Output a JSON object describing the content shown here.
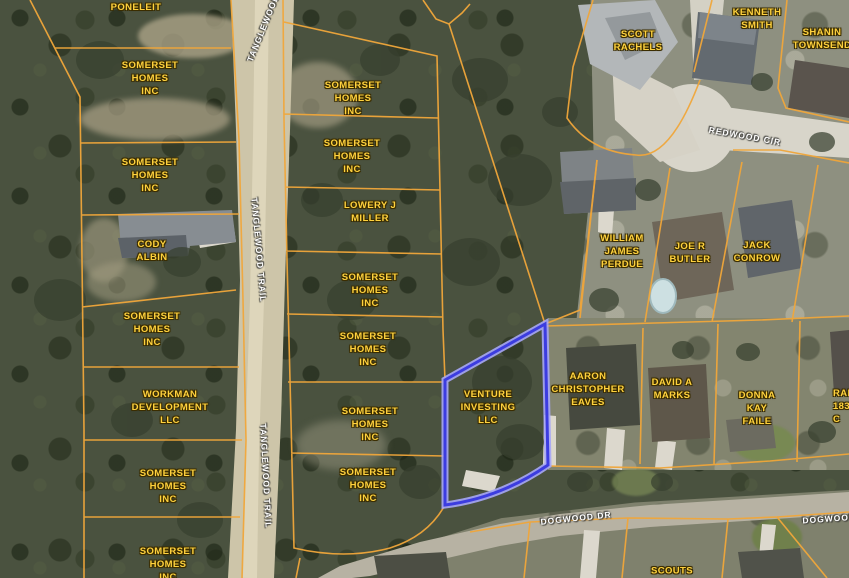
{
  "map_type": "parcel-aerial-map",
  "colors": {
    "parcel_line": "#f0a63a",
    "highlight_stroke": "#3c3ce0",
    "highlight_halo": "#a6a6f7",
    "owner_label": "#ffd23e",
    "owner_label_outline": "#3b2d00",
    "road_label": "#ffffff"
  },
  "selected_parcel": {
    "owner": "VENTURE INVESTING LLC"
  },
  "parcel_labels": [
    {
      "id": "poneleit",
      "text": "PONELEIT"
    },
    {
      "id": "somerset-1",
      "text": "SOMERSET\nHOMES\nINC"
    },
    {
      "id": "somerset-2",
      "text": "SOMERSET\nHOMES\nINC"
    },
    {
      "id": "cody-albin",
      "text": "CODY\nALBIN"
    },
    {
      "id": "somerset-3",
      "text": "SOMERSET\nHOMES\nINC"
    },
    {
      "id": "workman",
      "text": "WORKMAN\nDEVELOPMENT\nLLC"
    },
    {
      "id": "somerset-4",
      "text": "SOMERSET\nHOMES\nINC"
    },
    {
      "id": "somerset-5",
      "text": "SOMERSET\nHOMES\nINC"
    },
    {
      "id": "somerset-6",
      "text": "SOMERSET\nHOMES\nINC"
    },
    {
      "id": "somerset-7",
      "text": "SOMERSET\nHOMES\nINC"
    },
    {
      "id": "lowery-miller",
      "text": "LOWERY J\nMILLER"
    },
    {
      "id": "somerset-8",
      "text": "SOMERSET\nHOMES\nINC"
    },
    {
      "id": "somerset-9",
      "text": "SOMERSET\nHOMES\nINC"
    },
    {
      "id": "somerset-10",
      "text": "SOMERSET\nHOMES\nINC"
    },
    {
      "id": "somerset-11",
      "text": "SOMERSET\nHOMES\nINC"
    },
    {
      "id": "venture-investing",
      "text": "VENTURE\nINVESTING\nLLC"
    },
    {
      "id": "scott-rachels",
      "text": "SCOTT\nRACHELS"
    },
    {
      "id": "kenneth-smith",
      "text": "KENNETH\nSMITH"
    },
    {
      "id": "shanin-townsend",
      "text": "SHANIN\nTOWNSEND"
    },
    {
      "id": "william-perdue",
      "text": "WILLIAM\nJAMES\nPERDUE"
    },
    {
      "id": "joe-butler",
      "text": "JOE R\nBUTLER"
    },
    {
      "id": "jack-conrow",
      "text": "JACK\nCONROW"
    },
    {
      "id": "aaron-eaves",
      "text": "AARON\nCHRISTOPHER\nEAVES"
    },
    {
      "id": "david-marks",
      "text": "DAVID A\nMARKS"
    },
    {
      "id": "donna-faile",
      "text": "DONNA\nKAY\nFAILE"
    },
    {
      "id": "ranch-1836",
      "text": "RANC\n1836 C"
    },
    {
      "id": "scouts",
      "text": "SCOUTS"
    }
  ],
  "road_labels": [
    {
      "id": "tanglewood-top",
      "text": "TANGLEWOOD"
    },
    {
      "id": "tanglewood-trail-mid",
      "text": "TANGLEWOOD TRAIL"
    },
    {
      "id": "tanglewood-trail-low",
      "text": "TANGLEWOOD TRAIL"
    },
    {
      "id": "redwood-cir",
      "text": "REDWOOD CIR"
    },
    {
      "id": "dogwood-dr",
      "text": "DOGWOOD DR"
    },
    {
      "id": "dogwood-dr-east",
      "text": "DOGWOOD DR"
    }
  ]
}
